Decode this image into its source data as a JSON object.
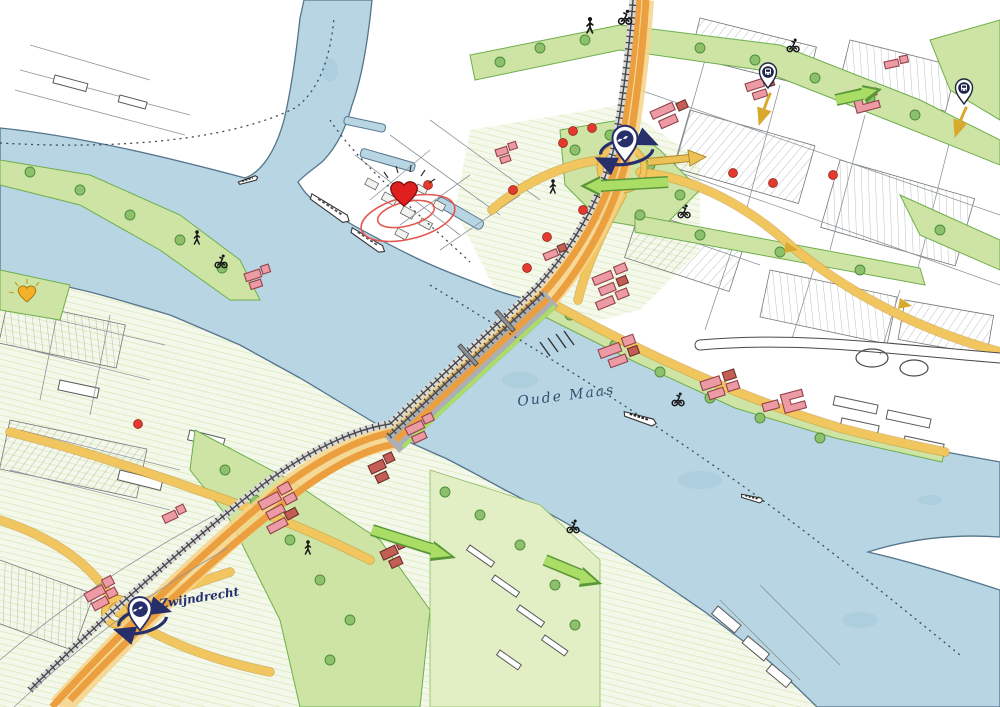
{
  "map": {
    "type": "illustrated-urban-vision-map",
    "labels": {
      "river": "Oude Maas",
      "station_zwijndrecht": "Zwijndrecht"
    },
    "colors": {
      "water": "#b7d5e3",
      "shoreline": "#55758c",
      "green_area": "#cde4a4",
      "tree": "#8cc06a",
      "road_yellow": "#f2c65f",
      "motorway_orange": "#ec9f3e",
      "building_new_pink": "#ec9aa4",
      "building_new_red": "#c25e55",
      "ns_navy": "#272f6b",
      "heart_red": "#e0201f",
      "heart_yellow": "#f3b229",
      "poi_dot_red": "#e23a2e",
      "green_arrow": "#aadd66",
      "ink": "#161616"
    },
    "markers": {
      "station_pins": [
        {
          "id": "dordrecht-station-pin",
          "logo": "ns-logo",
          "label": ""
        },
        {
          "id": "zwijndrecht-station-pin",
          "logo": "ns-logo",
          "label": "Zwijndrecht"
        }
      ],
      "heart_markers": [
        {
          "id": "city-centre-heart",
          "color": "#e0201f"
        },
        {
          "id": "west-district-heart",
          "color": "#f3b229"
        }
      ],
      "transit_stop_pins": [
        {
          "id": "transit-stop-pin-north"
        },
        {
          "id": "transit-stop-pin-far-east"
        }
      ],
      "poi_dot_count": 12,
      "poi_dot_color": "#e23a2e"
    },
    "figures": {
      "pedestrians": 4,
      "cyclists": 6,
      "boats": 5
    },
    "routes": {
      "dotted_ferry_routes": 3,
      "green_connection_arrows": 4
    }
  }
}
